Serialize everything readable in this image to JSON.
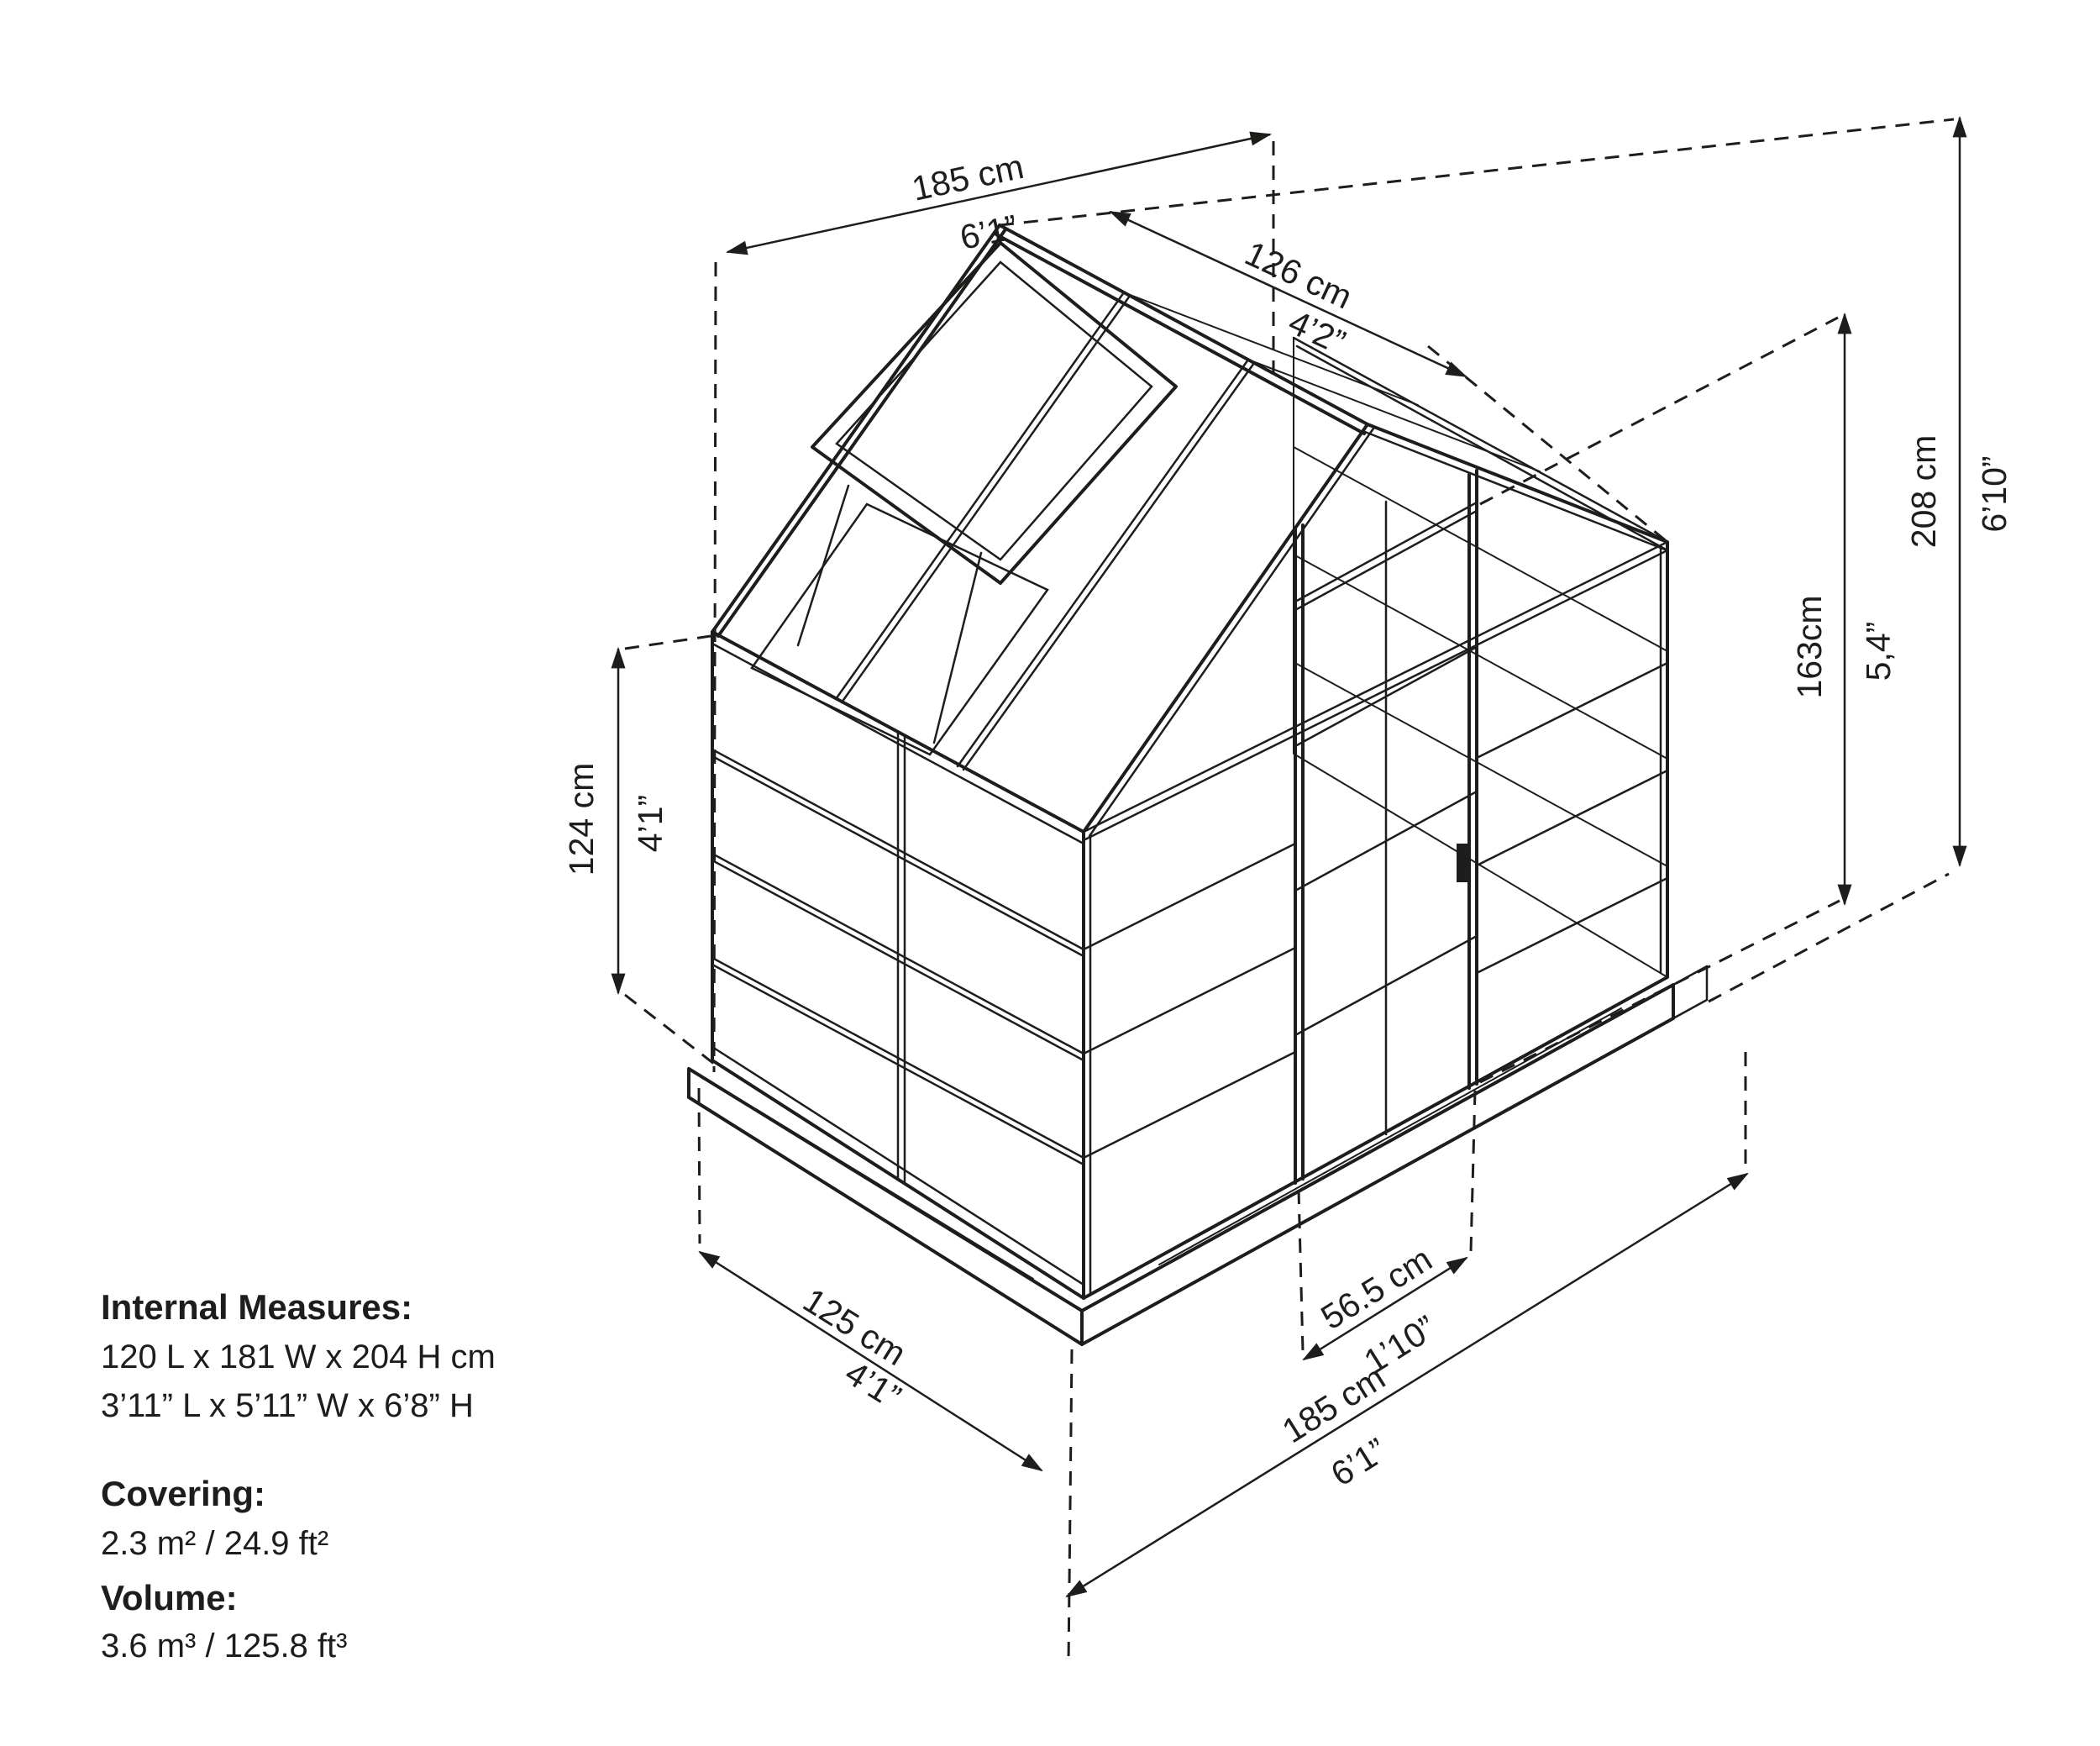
{
  "title": "Greenhouse dimensional diagram",
  "colors": {
    "line": "#1d1d1b",
    "background": "#ffffff"
  },
  "dims": {
    "width_top": {
      "cm": "185 cm",
      "imp": "6’1”"
    },
    "roof_slope": {
      "cm": "126 cm",
      "imp": "4’2”"
    },
    "total_height": {
      "cm": "208 cm",
      "imp": "6’10”"
    },
    "door_height": {
      "cm": "163cm",
      "imp": "5,4”"
    },
    "wall_height": {
      "cm": "124 cm",
      "imp": "4’1”"
    },
    "depth_bottom": {
      "cm": "125 cm",
      "imp": "4’1”"
    },
    "door_width": {
      "cm": "56.5 cm",
      "imp": "1’10”"
    },
    "width_bottom": {
      "cm": "185 cm",
      "imp": "6’1”"
    }
  },
  "specs": {
    "internal_label": "Internal Measures:",
    "internal_metric": "120 L x 181 W x 204 H cm",
    "internal_imperial": "3’11” L x 5’11” W x 6’8” H",
    "covering_label": "Covering:",
    "covering_value": "2.3 m² / 24.9 ft²",
    "volume_label": "Volume:",
    "volume_value": "3.6 m³ / 125.8 ft³"
  }
}
